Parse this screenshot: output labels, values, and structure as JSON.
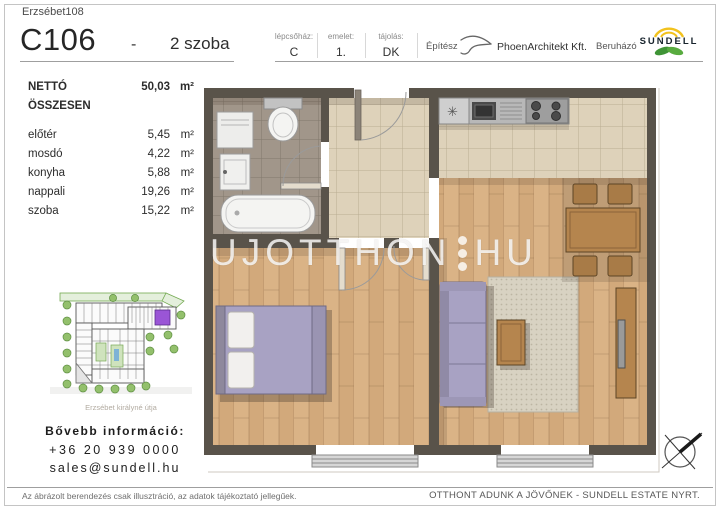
{
  "header": {
    "project": "Erzsébet108",
    "unit_id": "C106",
    "separator": "-",
    "unit_type": "2 szoba",
    "meta": [
      {
        "label": "lépcsőház:",
        "value": "C"
      },
      {
        "label": "emelet:",
        "value": "1."
      },
      {
        "label": "tájolás:",
        "value": "DK"
      }
    ],
    "architect_label": "Építész",
    "architect_name": "PhoenArchitekt Kft.",
    "developer_label": "Beruházó",
    "developer_name": "SUNDELL"
  },
  "areas": {
    "total_label": "NETTÓ ÖSSZESEN",
    "total_value": "50,03",
    "unit": "m²",
    "rooms": [
      {
        "name": "előtér",
        "value": "5,45"
      },
      {
        "name": "mosdó",
        "value": "4,22"
      },
      {
        "name": "konyha",
        "value": "5,88"
      },
      {
        "name": "nappali",
        "value": "19,26"
      },
      {
        "name": "szoba",
        "value": "15,22"
      }
    ]
  },
  "site_plan": {
    "caption": "Erzsébet királyné útja",
    "highlight_color": "#9a55d6"
  },
  "contact": {
    "title": "Bővebb információ:",
    "phone": "+36 20 939 0000",
    "email": "sales@sundell.hu"
  },
  "watermark": {
    "left": "UJOTTHON",
    "right": "HU"
  },
  "footer": {
    "disclaimer": "Az ábrázolt berendezés csak illusztráció, az adatok tájékoztató jellegűek.",
    "slogan": "OTTHONT ADUNK A JÖVŐNEK - SUNDELL ESTATE NYRT."
  },
  "colors": {
    "wall": "#59534a",
    "tile_beige": "#ded2ba",
    "tile_bath": "#a1968a",
    "wood": "#d8b084",
    "furniture_purple": "#a8a2c3",
    "logo_yellow": "#f2c21d",
    "logo_green": "#4e9e38"
  }
}
